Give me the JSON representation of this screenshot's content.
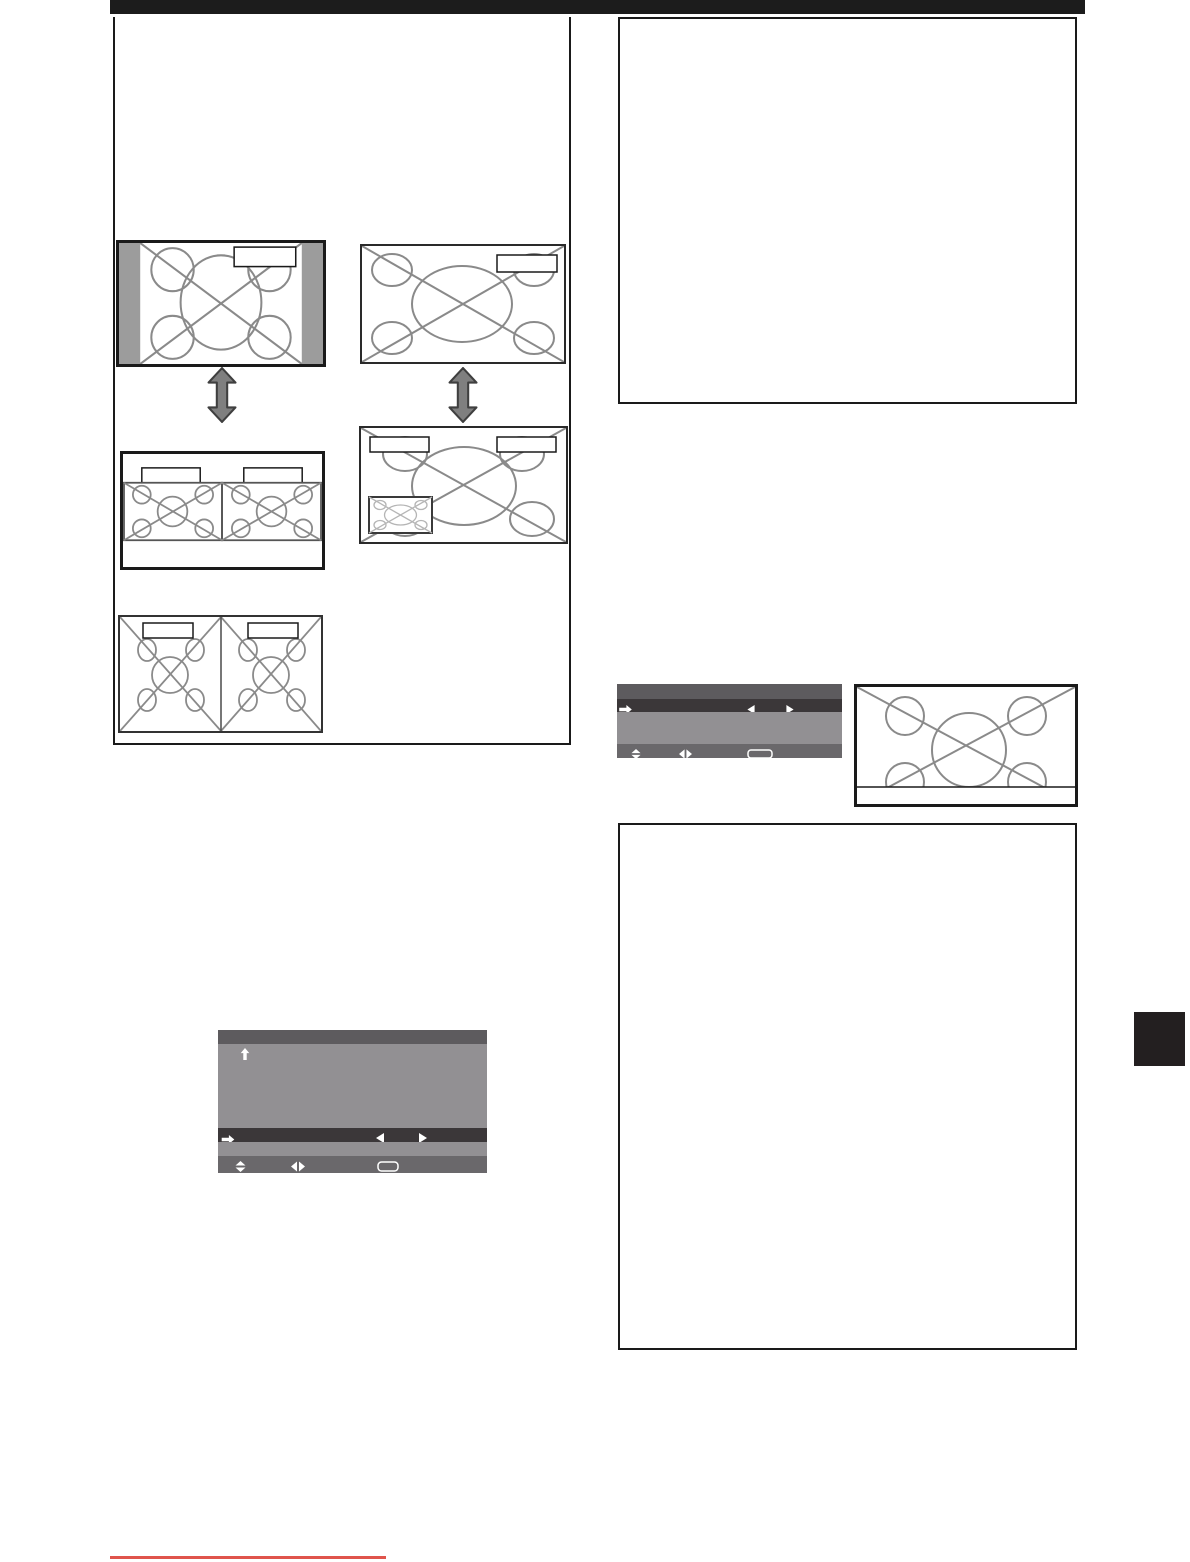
{
  "page": {
    "kind": "user-manual-page",
    "background": "#ffffff",
    "top_rule_color": "#1c1c1c",
    "section_side_tab_color": "#231f20",
    "bottom_rule_color": "#e0544c"
  },
  "palette": {
    "box_border": "#1a1a1a",
    "diagram_stroke": "#8a8a8a",
    "pillarbox_gray": "#9c9c9c",
    "transition_arrow_fill": "#7f7f7f",
    "transition_arrow_outline": "#3f3f3f",
    "osd_header": "#5d5b5e",
    "osd_body": "#929093",
    "osd_selected_row": "#3b3739",
    "osd_footer": "#6a686b",
    "osd_glyph_color": "#ffffff",
    "pip_inner_stroke": "#b5b5b5"
  },
  "left_panel": {
    "diagrams": [
      {
        "id": "pillarbox-4x3-screen",
        "labels": [
          ""
        ]
      },
      {
        "id": "full-16x9-screen",
        "labels": [
          ""
        ]
      },
      {
        "id": "two-screen-split",
        "labels": [
          "",
          ""
        ]
      },
      {
        "id": "picture-in-picture-screen",
        "labels": [
          "",
          ""
        ]
      },
      {
        "id": "dual-full-screen",
        "labels": [
          "",
          ""
        ]
      }
    ],
    "transition_icon": "up-down-double-arrow"
  },
  "right_column": {
    "note_boxes": 2,
    "letterbox_screen": {
      "id": "screen-with-bottom-strip",
      "labels": []
    }
  },
  "osd_menus": [
    {
      "id": "small-osd",
      "rows": [
        "header",
        "selected",
        "body",
        "footer"
      ],
      "selected_row_icons": [
        "right-arrow-icon",
        "left-triangle-icon",
        "right-triangle-icon"
      ],
      "footer_icons": [
        "up-down-triangles-icon",
        "left-right-triangles-icon",
        "enter-button-outline-icon"
      ]
    },
    {
      "id": "large-osd",
      "rows": [
        "header",
        "body",
        "selected",
        "thin",
        "footer"
      ],
      "body_icons": [
        "up-arrow-icon"
      ],
      "selected_row_icons": [
        "right-arrow-icon",
        "left-triangle-icon",
        "right-triangle-icon"
      ],
      "footer_icons": [
        "up-down-triangles-icon",
        "left-right-triangles-icon",
        "enter-button-outline-icon"
      ]
    }
  ]
}
